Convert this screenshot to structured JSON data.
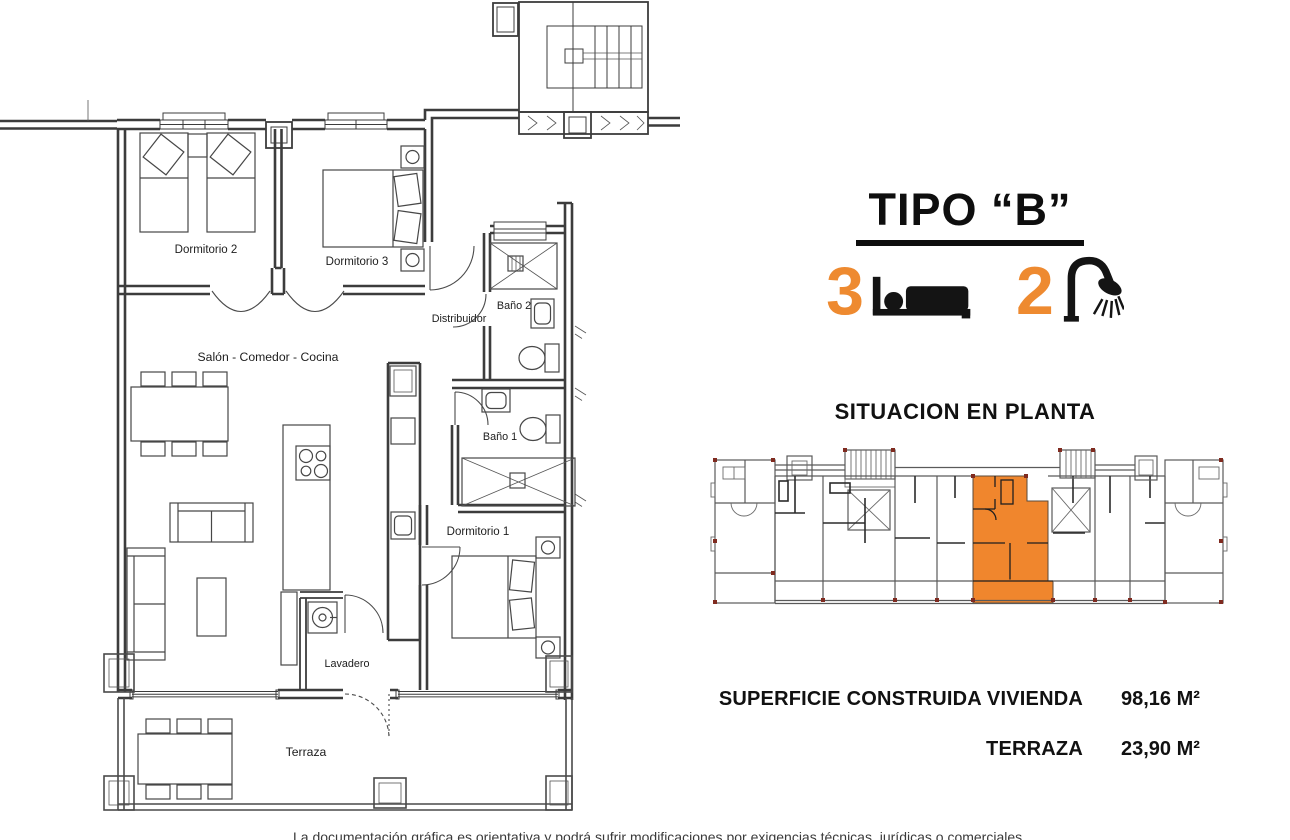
{
  "page": {
    "background_color": "#ffffff"
  },
  "header": {
    "title": "TIPO “B”",
    "bedrooms_count": "3",
    "bathrooms_count": "2",
    "accent_color": "#EE8A30"
  },
  "floor_plan": {
    "rooms": [
      {
        "label": "Dormitorio 2"
      },
      {
        "label": "Dormitorio 3"
      },
      {
        "label": "Baño 2"
      },
      {
        "label": "Distribuidor"
      },
      {
        "label": "Salón - Comedor - Cocina"
      },
      {
        "label": "Baño 1"
      },
      {
        "label": "Dormitorio 1"
      },
      {
        "label": "Lavadero"
      },
      {
        "label": "Terraza"
      }
    ]
  },
  "situation": {
    "title": "SITUACION EN PLANTA",
    "highlight_color": "#F0862D"
  },
  "areas": {
    "rows": [
      {
        "label": "SUPERFICIE CONSTRUIDA VIVIENDA",
        "value": "98,16 M²"
      },
      {
        "label": "TERRAZA",
        "value": "23,90 M²"
      }
    ]
  },
  "footer": {
    "clipped_text": "La documentación gráfica es orientativa y podrá sufrir modificaciones por exigencias técnicas, jurídicas o comerciales."
  }
}
